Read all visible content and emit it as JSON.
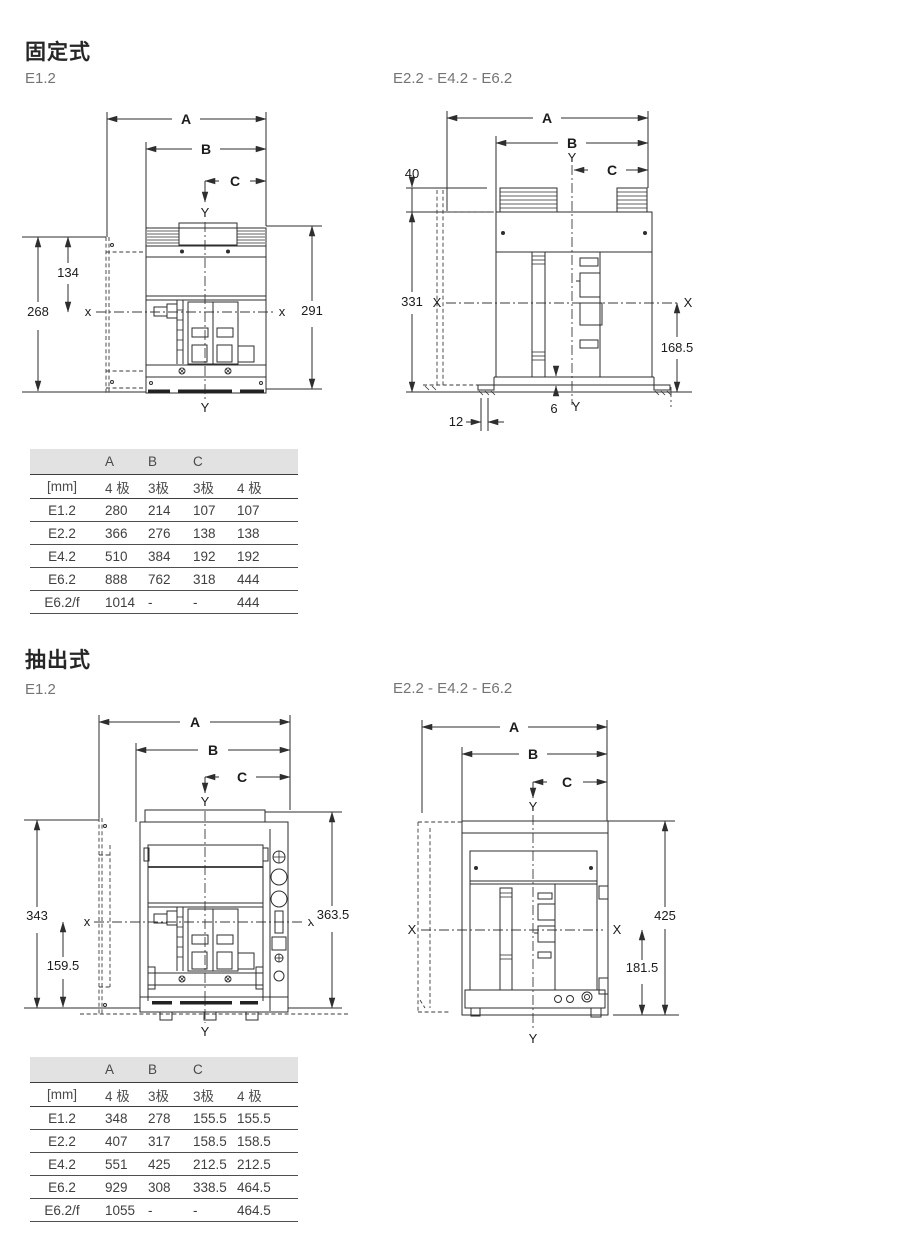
{
  "page": {
    "sections": [
      {
        "title": "固定式",
        "figures": [
          {
            "label": "E1.2",
            "dims": {
              "a": "A",
              "b": "B",
              "c": "C",
              "y_top": "Y",
              "y_bottom": "Y",
              "x_left": "x",
              "x_right": "x",
              "left_total": "268",
              "left_upper": "134",
              "right_total": "291"
            }
          },
          {
            "label": "E2.2 - E4.2 - E6.2",
            "dims": {
              "a": "A",
              "b": "B",
              "c": "C",
              "y_top": "Y",
              "y_bottom": "Y",
              "x_left": "X",
              "x_right": "X",
              "terminal_height": "40",
              "left_total": "331",
              "right_lower": "168.5",
              "base_plate": "6",
              "foot_offset": "12"
            }
          }
        ],
        "table": {
          "group_headers": [
            "A",
            "B",
            "C"
          ],
          "unit_label": "[mm]",
          "pole_headers": [
            "4 极",
            "3极",
            "3极",
            "4 极"
          ],
          "rows": [
            {
              "name": "E1.2",
              "values": [
                "280",
                "214",
                "107",
                "107"
              ]
            },
            {
              "name": "E2.2",
              "values": [
                "366",
                "276",
                "138",
                "138"
              ]
            },
            {
              "name": "E4.2",
              "values": [
                "510",
                "384",
                "192",
                "192"
              ]
            },
            {
              "name": "E6.2",
              "values": [
                "888",
                "762",
                "318",
                "444"
              ]
            },
            {
              "name": "E6.2/f",
              "values": [
                "1014",
                "-",
                "-",
                "444"
              ]
            }
          ]
        }
      },
      {
        "title": "抽出式",
        "figures": [
          {
            "label": "E1.2",
            "dims": {
              "a": "A",
              "b": "B",
              "c": "C",
              "y_top": "Y",
              "y_bottom": "Y",
              "x_left": "x",
              "x_right": "x",
              "left_total": "343",
              "left_lower": "159.5",
              "right_total": "363.5"
            }
          },
          {
            "label": "E2.2 - E4.2 - E6.2",
            "dims": {
              "a": "A",
              "b": "B",
              "c": "C",
              "y_top": "Y",
              "y_bottom": "Y",
              "x_left": "X",
              "x_right": "X",
              "right_total": "425",
              "right_lower": "181.5"
            }
          }
        ],
        "table": {
          "group_headers": [
            "A",
            "B",
            "C"
          ],
          "unit_label": "[mm]",
          "pole_headers": [
            "4 极",
            "3极",
            "3极",
            "4 极"
          ],
          "rows": [
            {
              "name": "E1.2",
              "values": [
                "348",
                "278",
                "155.5",
                "155.5"
              ]
            },
            {
              "name": "E2.2",
              "values": [
                "407",
                "317",
                "158.5",
                "158.5"
              ]
            },
            {
              "name": "E4.2",
              "values": [
                "551",
                "425",
                "212.5",
                "212.5"
              ]
            },
            {
              "name": "E6.2",
              "values": [
                "929",
                "308",
                "338.5",
                "464.5"
              ]
            },
            {
              "name": "E6.2/f",
              "values": [
                "1055",
                "-",
                "-",
                "464.5"
              ]
            }
          ]
        }
      }
    ]
  }
}
